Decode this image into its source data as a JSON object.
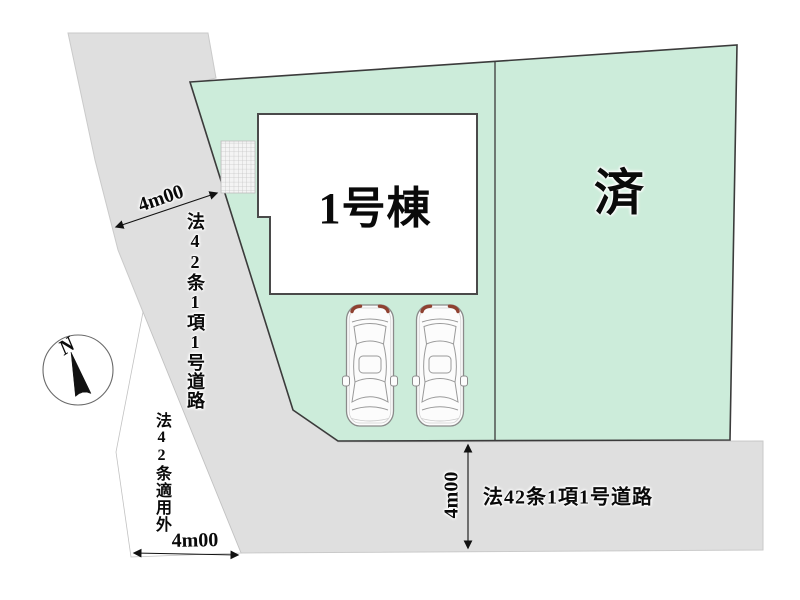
{
  "site_plan": {
    "building_label": "1号棟",
    "sold_label": "済",
    "west_road_label": "法42条1項1号道路",
    "south_road_label": "法42条1項1号道路",
    "excluded_area_label": "法42条適用外",
    "dim_west_width": "4m00",
    "dim_south_left_width": "4m00",
    "dim_south_road_width": "4m00",
    "compass_label": "N",
    "colors": {
      "lot_fill": "#ccecda",
      "road_fill": "#dfdfdf",
      "boundary_line": "#3b3b3b",
      "car_taillight": "#8f4130"
    },
    "icons": {
      "compass": "north-compass-icon",
      "car": "car-icon",
      "tiles": "tile-grid-icon"
    }
  }
}
